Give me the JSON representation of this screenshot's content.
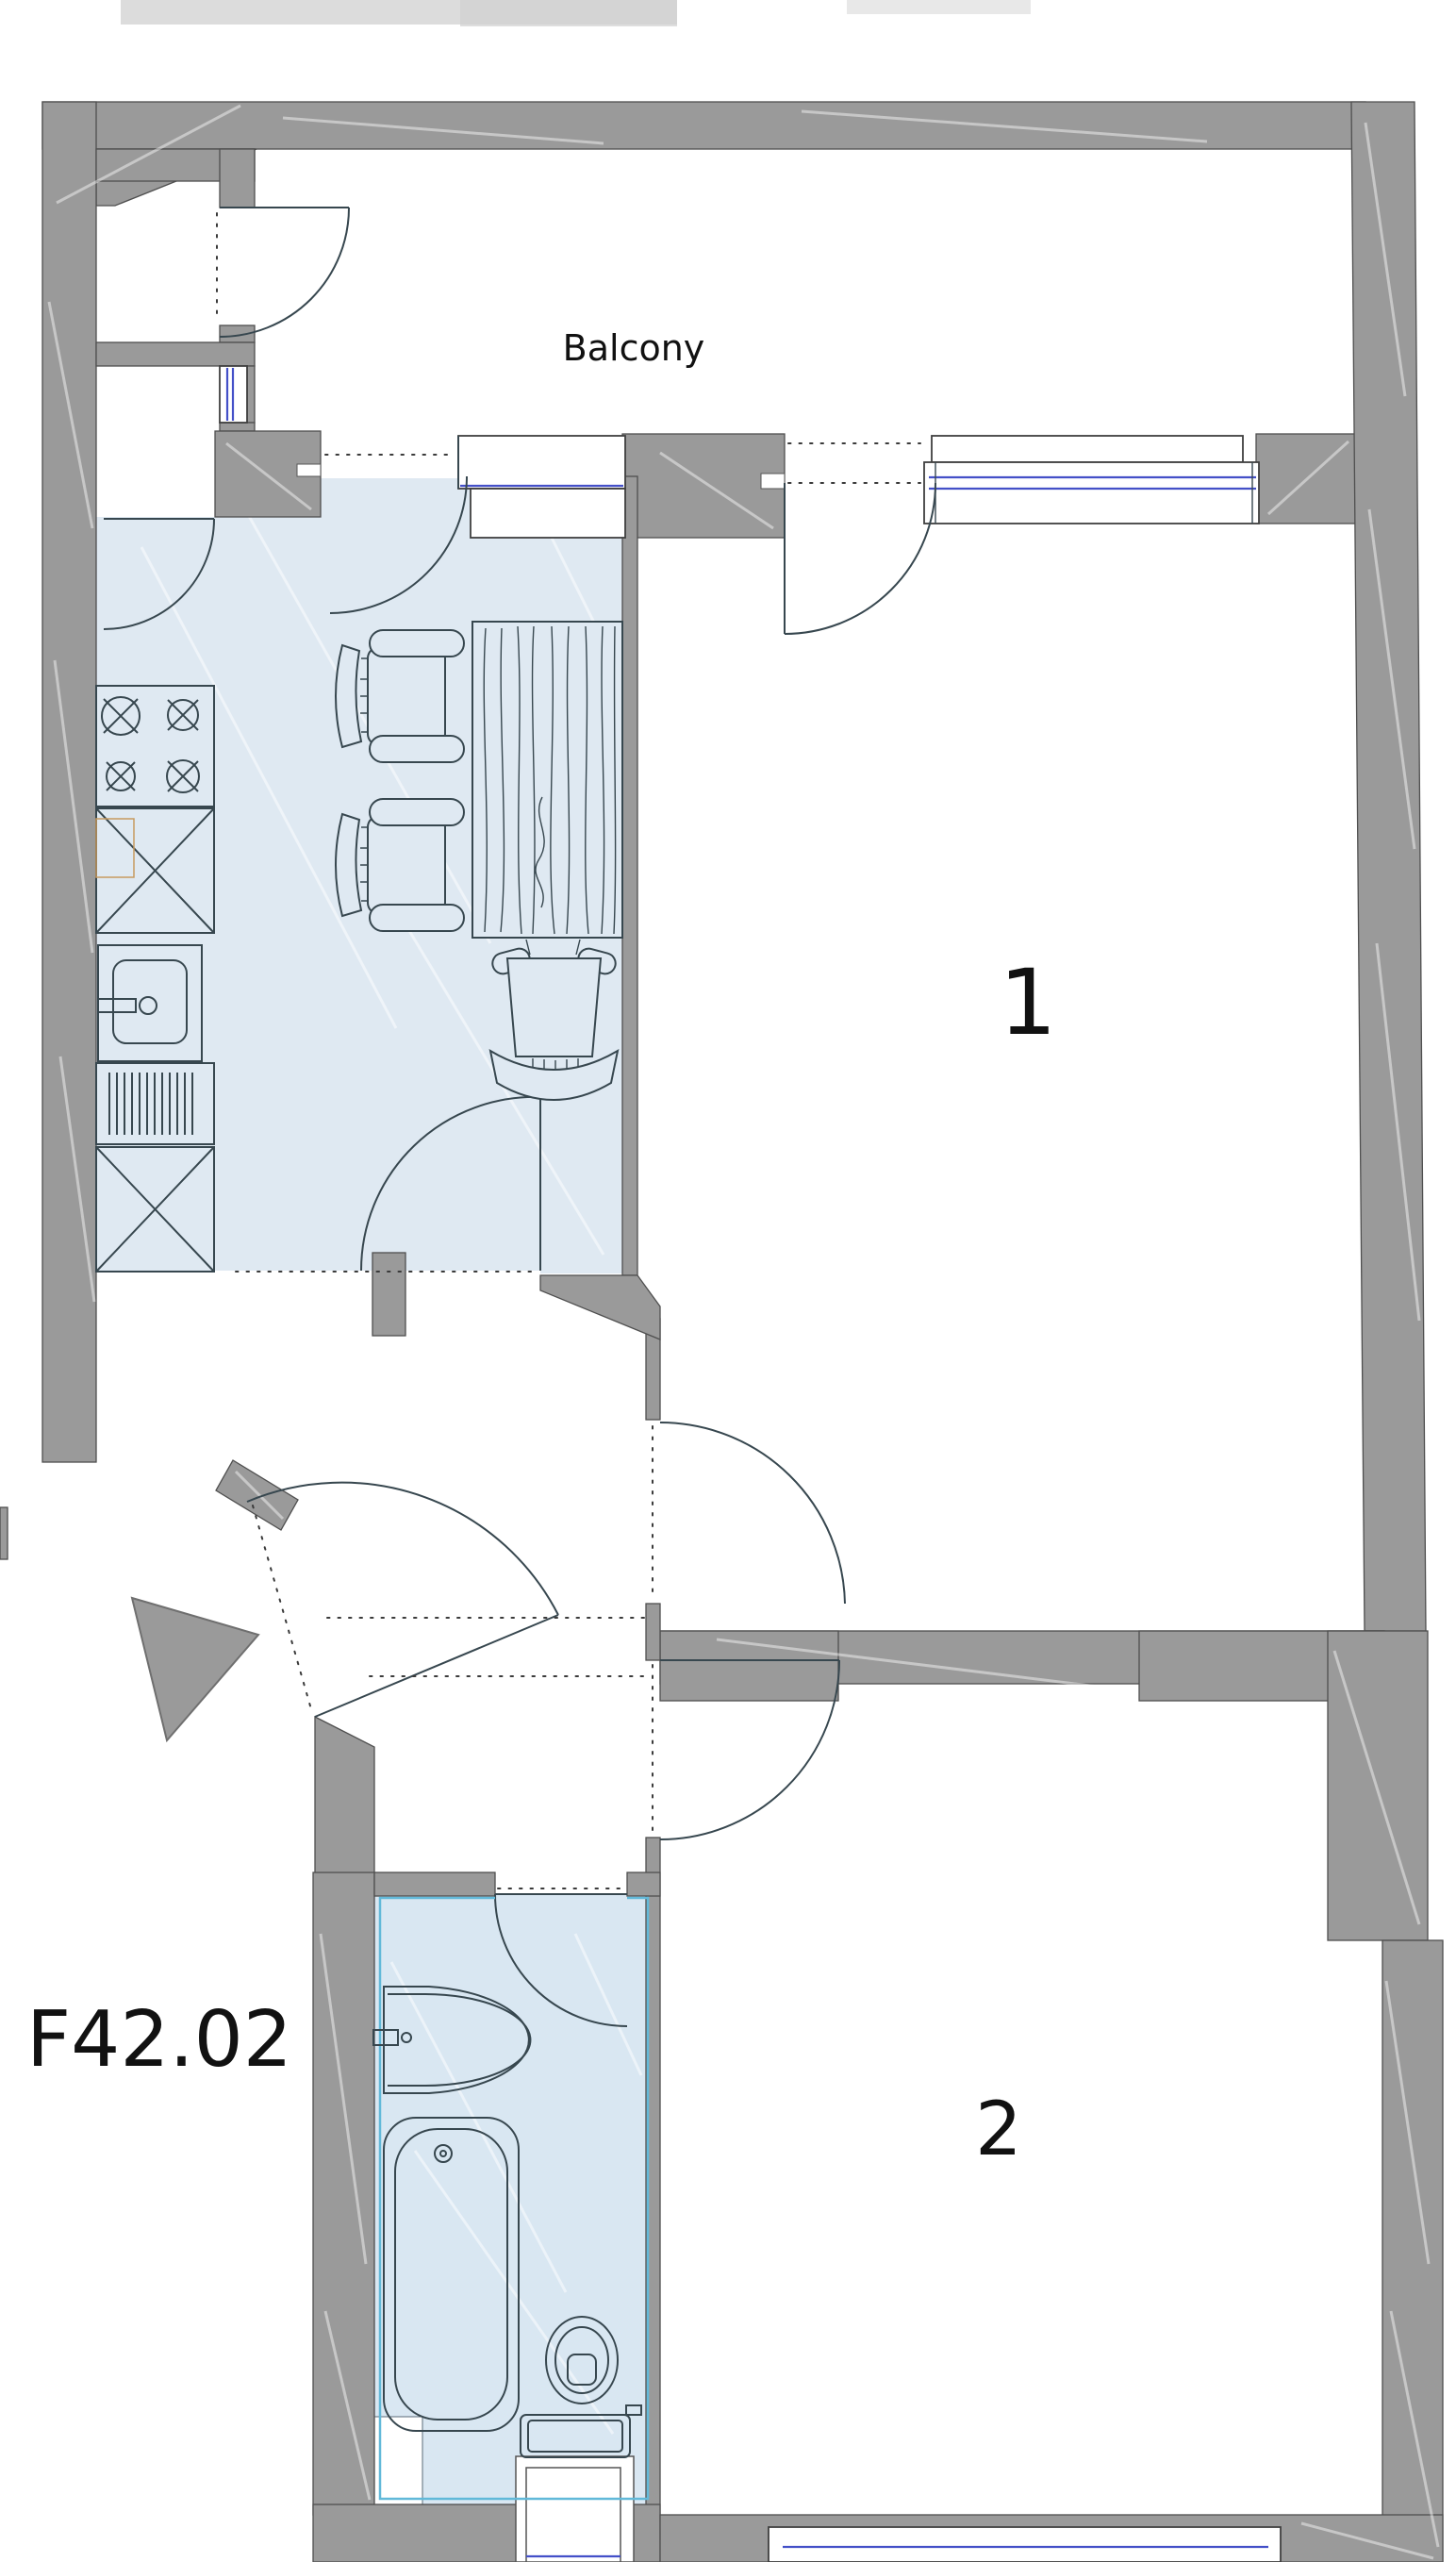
{
  "labels": {
    "balcony": "Balcony",
    "room_1": "1",
    "room_2": "2",
    "plan_code": "F42.02"
  },
  "colors": {
    "wall": "#9a9a9a",
    "wall_edge": "#4f4f4f",
    "wall_streak": "#ffffff",
    "floor_highlight": "#dfe9f2",
    "bath_highlight": "#d9e7f2",
    "window_glass": "#4450c8",
    "bath_outline": "#62b9d9",
    "drawing_line": "#37474f",
    "label_text": "#111111",
    "artifact_gray": "#d8d8d8"
  },
  "rooms": [
    {
      "id": "balcony",
      "highlighted": false
    },
    {
      "id": "room-1",
      "highlighted": false
    },
    {
      "id": "room-2",
      "highlighted": false
    },
    {
      "id": "kitchen",
      "highlighted": true
    },
    {
      "id": "bathroom",
      "highlighted": true
    }
  ],
  "fixtures": {
    "kitchen": [
      "stove",
      "cabinet",
      "kitchen-sink",
      "dishwasher",
      "dining-table",
      "chair",
      "chair",
      "armchair"
    ],
    "bathroom": [
      "wash-basin",
      "bathtub",
      "toilet"
    ]
  }
}
